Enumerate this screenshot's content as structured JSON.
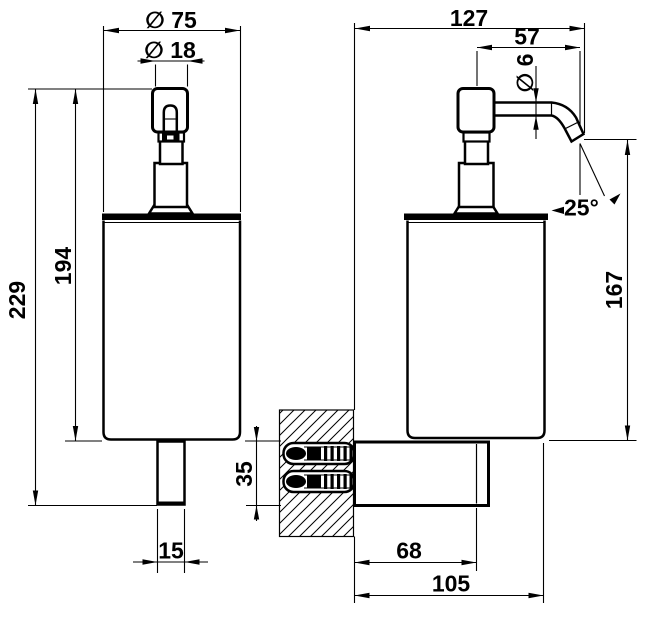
{
  "drawing": {
    "subject": "Wall-mounted soap dispenser - dimensioned technical drawing",
    "views": [
      "front view",
      "side view with wall mounting section"
    ],
    "units": "mm",
    "background": "#ffffff",
    "line_color": "#000000"
  },
  "labels": {
    "dia75": "∅ 75",
    "dia18": "∅ 18",
    "h194": "194",
    "h229": "229",
    "w15": "15",
    "d127": "127",
    "d57": "57",
    "dia6": "∅ 6",
    "a25": "25°",
    "h167": "167",
    "h35": "35",
    "d68": "68",
    "d105": "105"
  },
  "dimensions_mm": {
    "front_view": {
      "body_diameter": 75,
      "pump_neck_diameter": 18,
      "pump_top_to_body_bottom": 194,
      "overall_height": 229,
      "bottom_stem_width": 15
    },
    "side_view": {
      "wall_to_spout_tip": 127,
      "pump_axis_to_spout_tip": 57,
      "spout_tube_diameter": 6,
      "spout_angle_deg": 25,
      "spout_outlet_to_body_bottom": 167,
      "bracket_height": 35,
      "wall_to_bracket_front": 68,
      "wall_to_body_front": 105
    }
  }
}
